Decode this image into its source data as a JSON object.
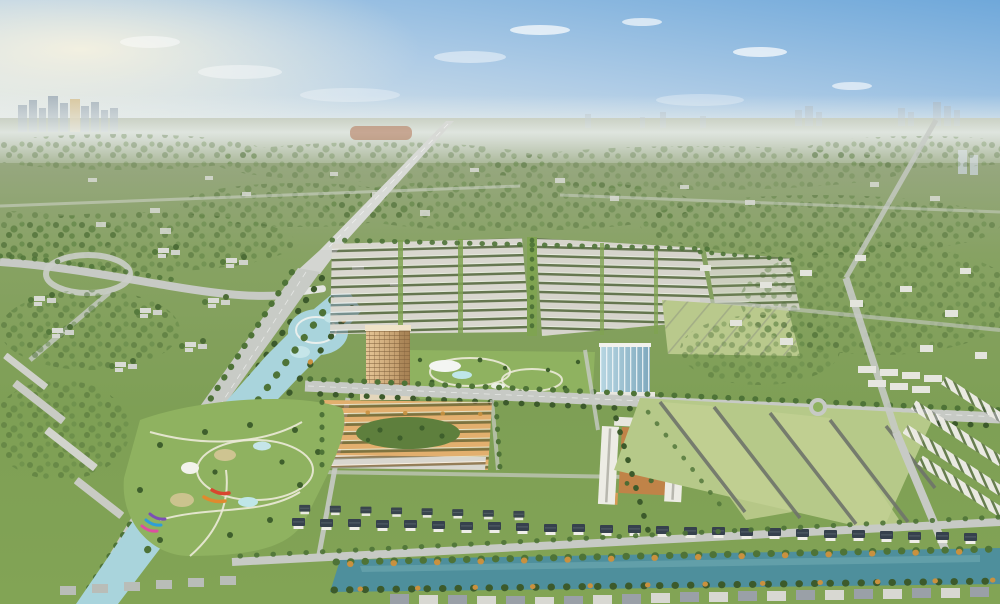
{
  "scene": {
    "type": "aerial-masterplan-render",
    "description": "Aerial 3D rendering of a master-planned green township: a grid of white shophouse rows, a tan residential tower and a blue glass tower flanking a central park, an orange-facade commercial block, courtyard apartments, large subdivided field plots, rows of dark-roofed villas along a landscaped canal, a theme park with colorful slides, a lagoon water park, tree-lined boulevards and a straight expressway receding to a hazy city skyline on the horizon.",
    "palette": {
      "sky_top": "#6FA8DA",
      "sky_mid": "#AFCCE6",
      "sky_horizon": "#ECEFEA",
      "sun_glow": "#F8F3E0",
      "haze": "#E9EEEC",
      "land_far": "#A9B29A",
      "land_midfar": "#96A77E",
      "land_mid": "#87A263",
      "land_near": "#7E9F55",
      "land_front": "#82A455",
      "lawn": "#8FB260",
      "field_light": "#B6C989",
      "field_lighter": "#C3D194",
      "tree_dark": "#45662F",
      "tree_mid": "#567A3D",
      "road_light": "#C7CAC5",
      "road_far": "#D8DAD6",
      "road_dark": "#6F746B",
      "water_teal": "#4E8F9C",
      "water_light": "#A9D4DC",
      "pool_cyan": "#BFE6E8",
      "roof_dark": "#36414D",
      "roof_light": "#D9D7CF",
      "wall_white": "#F0EFE9",
      "tower_tan_light": "#E6C697",
      "tower_tan_dark": "#B68F5E",
      "glass_light": "#B7D6E2",
      "glass_dark": "#7FA9BE",
      "orange_facade": "#E2AF6E",
      "orange_court": "#C08348",
      "terracotta": "#B06A48",
      "path_cream": "#ECEAD9",
      "autumn_tree": "#C9913F",
      "skyline_gray": "#98A6B2",
      "skyline_tan": "#D6C08F",
      "cloud_white": "#FFFFFF"
    },
    "landmarks": [
      {
        "id": "sky",
        "label": "Hazy morning sky with scattered clouds"
      },
      {
        "id": "distant-city",
        "label": "Distant city skyline on the horizon"
      },
      {
        "id": "expressway",
        "label": "Straight expressway receding to the horizon"
      },
      {
        "id": "shophouse-grid",
        "label": "Grid of low-rise shophouse rows"
      },
      {
        "id": "tan-tower",
        "label": "Tan high-rise apartment tower"
      },
      {
        "id": "glass-tower",
        "label": "Blue glass mid-rise tower"
      },
      {
        "id": "central-park",
        "label": "Central park with pools and palms"
      },
      {
        "id": "orange-commercial",
        "label": "Orange-facade commercial shophouse block"
      },
      {
        "id": "courtyard-block",
        "label": "Courtyard apartment block with orange facades"
      },
      {
        "id": "sports-fields",
        "label": "Large green field plots divided by access roads"
      },
      {
        "id": "villa-row",
        "label": "Row of detached villas with dark roofs"
      },
      {
        "id": "west-canal",
        "label": "Landscaped canal running to the south-west"
      },
      {
        "id": "theme-park",
        "label": "Theme park with colorful slides and white canopy"
      },
      {
        "id": "lagoon",
        "label": "Lagoon water park"
      },
      {
        "id": "boulevard",
        "label": "Tree-lined boulevard"
      },
      {
        "id": "main-avenue",
        "label": "Main east-west avenue"
      },
      {
        "id": "south-canal",
        "label": "Tree-lined canal along the villa row"
      },
      {
        "id": "suburbs",
        "label": "Surrounding suburban districts and greenery"
      }
    ]
  }
}
